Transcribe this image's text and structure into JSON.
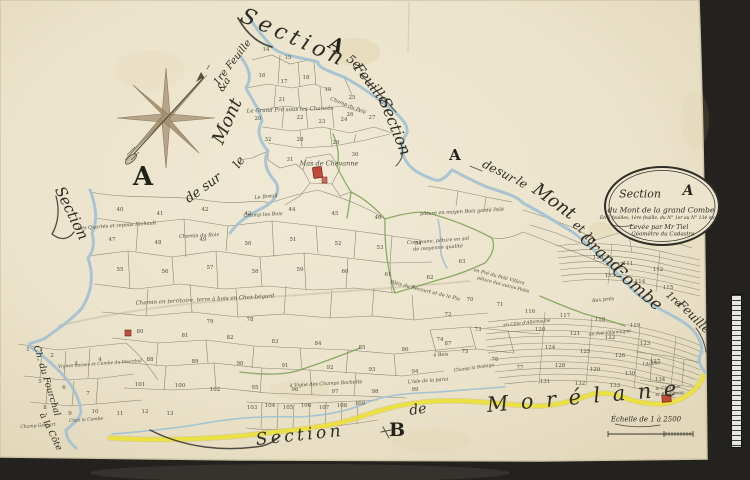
{
  "colors": {
    "background": "#24221f",
    "paper": "#ebe3cb",
    "river": "#a4c2d3",
    "road": "#ece23f",
    "hedge": "#7b9f55",
    "ink": "#2e2d23",
    "building": "#c14a39"
  },
  "cartouche": {
    "word": "Section",
    "letter": "A",
    "line2": "du Mont de la grand Combe",
    "line3": "En 5 feuilles, 1ère feuille, du N° 1er au N° 134 inclus",
    "line4": "Levée par Mr Tiel",
    "line5": "Géomètre du Cadastre"
  },
  "scale_bar": {
    "label": "Échelle de 1 à 2500"
  },
  "map": {
    "script_labels": [
      {
        "t": "Section",
        "x": 293,
        "y": 40,
        "r": 24,
        "s": 22,
        "ls": 2
      },
      {
        "t": "A",
        "x": 335,
        "y": 47,
        "r": 30,
        "s": 19,
        "cls": "cap"
      },
      {
        "t": "5e",
        "x": 353,
        "y": 63,
        "r": 38,
        "s": 12
      },
      {
        "t": "Feuille",
        "x": 370,
        "y": 85,
        "r": 52,
        "s": 14
      },
      {
        "t": "Section",
        "x": 393,
        "y": 127,
        "r": 68,
        "s": 16
      },
      {
        "t": "1re Feuille",
        "x": 233,
        "y": 63,
        "r": -52,
        "s": 10
      },
      {
        "t": "&a",
        "x": 225,
        "y": 85,
        "r": -58,
        "s": 10
      },
      {
        "t": "Mont",
        "x": 229,
        "y": 122,
        "r": -66,
        "s": 18
      },
      {
        "t": "le",
        "x": 240,
        "y": 163,
        "r": -56,
        "s": 12
      },
      {
        "t": "de sur",
        "x": 204,
        "y": 189,
        "r": -36,
        "s": 13
      },
      {
        "t": "Section",
        "x": 70,
        "y": 214,
        "r": 64,
        "s": 15
      },
      {
        "t": "A",
        "x": 143,
        "y": 180,
        "r": 0,
        "s": 26,
        "cls": "cap"
      },
      {
        "t": "A",
        "x": 455,
        "y": 157,
        "r": 0,
        "s": 15,
        "cls": "cap"
      },
      {
        "t": "de",
        "x": 489,
        "y": 168,
        "r": 28,
        "s": 12
      },
      {
        "t": "sur",
        "x": 505,
        "y": 176,
        "r": 30,
        "s": 12
      },
      {
        "t": "le",
        "x": 521,
        "y": 184,
        "r": 33,
        "s": 12
      },
      {
        "t": "Mont",
        "x": 553,
        "y": 203,
        "r": 36,
        "s": 18
      },
      {
        "t": "et",
        "x": 578,
        "y": 228,
        "r": 38,
        "s": 12
      },
      {
        "t": "la",
        "x": 590,
        "y": 240,
        "r": 40,
        "s": 12
      },
      {
        "t": "Grand-",
        "x": 602,
        "y": 256,
        "r": 41,
        "s": 16
      },
      {
        "t": "Combe",
        "x": 636,
        "y": 289,
        "r": 41,
        "s": 17
      },
      {
        "t": "1re",
        "x": 673,
        "y": 300,
        "r": 42,
        "s": 10
      },
      {
        "t": "Feuille",
        "x": 693,
        "y": 318,
        "r": 45,
        "s": 12
      },
      {
        "t": "Section",
        "x": 300,
        "y": 437,
        "r": -6,
        "s": 17,
        "ls": 2
      },
      {
        "t": "B",
        "x": 397,
        "y": 432,
        "r": 0,
        "s": 19,
        "cls": "cap"
      },
      {
        "t": "de",
        "x": 418,
        "y": 411,
        "r": -8,
        "s": 14
      },
      {
        "t": "Morélane",
        "x": 588,
        "y": 399,
        "r": -5,
        "s": 21,
        "ls": 6
      },
      {
        "t": "Ch. du Fourchal",
        "x": 46,
        "y": 381,
        "r": 73,
        "s": 9
      },
      {
        "t": "à la Côte",
        "x": 50,
        "y": 432,
        "r": 64,
        "s": 9
      }
    ],
    "place_labels": [
      {
        "t": "Le Grand Pré sous les Chancés",
        "x": 290,
        "y": 110,
        "r": -2,
        "s": 5.5
      },
      {
        "t": "Champ du Pelé",
        "x": 348,
        "y": 106,
        "r": 22,
        "s": 5
      },
      {
        "t": "Mas de Chevanne",
        "x": 329,
        "y": 164,
        "r": 0,
        "s": 6.5
      },
      {
        "t": "Le Breuil",
        "x": 266,
        "y": 197,
        "r": -5,
        "s": 5
      },
      {
        "t": "Les Quartés et repous Richault",
        "x": 117,
        "y": 226,
        "r": -4,
        "s": 5
      },
      {
        "t": "Chemin du Bois",
        "x": 199,
        "y": 236,
        "r": -3,
        "s": 5
      },
      {
        "t": "Champ les Bois",
        "x": 263,
        "y": 215,
        "r": -3,
        "s": 5
      },
      {
        "t": "pâture en moyen Bois gardé Pelé",
        "x": 462,
        "y": 212,
        "r": -3,
        "s": 5
      },
      {
        "t": "Commune, pâture en sol",
        "x": 438,
        "y": 241,
        "r": -4,
        "s": 5
      },
      {
        "t": "de moyenne qualité",
        "x": 438,
        "y": 248,
        "r": -4,
        "s": 5
      },
      {
        "t": "Chemin en territoire, terre à bois en Chez-bégard",
        "x": 205,
        "y": 300,
        "r": -3,
        "s": 5.5
      },
      {
        "t": "Pâtis du Recourt et de la Pie",
        "x": 425,
        "y": 291,
        "r": 14,
        "s": 5
      },
      {
        "t": "en Pré du Pelé Villars",
        "x": 499,
        "y": 277,
        "r": 15,
        "s": 4.8
      },
      {
        "t": "pâture des autres Pelés",
        "x": 503,
        "y": 285,
        "r": 15,
        "s": 4.5
      },
      {
        "t": "Aux prés",
        "x": 603,
        "y": 300,
        "r": -5,
        "s": 5
      },
      {
        "t": "en Côte d'Allemagne",
        "x": 527,
        "y": 323,
        "r": -6,
        "s": 4.5
      },
      {
        "t": "en Pré Villemagne",
        "x": 610,
        "y": 333,
        "r": -5,
        "s": 4.5
      },
      {
        "t": "à Bois",
        "x": 441,
        "y": 355,
        "r": -3,
        "s": 4.8
      },
      {
        "t": "Champ la Rodage",
        "x": 474,
        "y": 368,
        "r": -8,
        "s": 4.5
      },
      {
        "t": "à Vigne des Champs Rochette",
        "x": 326,
        "y": 384,
        "r": -3,
        "s": 4.8
      },
      {
        "t": "L'isle de la paroi",
        "x": 428,
        "y": 381,
        "r": -4,
        "s": 4.8
      },
      {
        "t": "l'Aubier",
        "x": 652,
        "y": 364,
        "r": -5,
        "s": 4.5
      },
      {
        "t": "le Clos aux",
        "x": 668,
        "y": 388,
        "r": -5,
        "s": 4.5
      },
      {
        "t": "et Bourgeois",
        "x": 670,
        "y": 394,
        "r": -5,
        "s": 4.5
      },
      {
        "t": "Vignes basses et Combe du Fourchal",
        "x": 100,
        "y": 364,
        "r": -4,
        "s": 4.5
      },
      {
        "t": "Champ Gerbert",
        "x": 38,
        "y": 426,
        "r": -4,
        "s": 4.5
      },
      {
        "t": "Chez la Combe",
        "x": 86,
        "y": 420,
        "r": -4,
        "s": 4.5
      },
      {
        "t": "1",
        "x": 208,
        "y": 68,
        "r": 20,
        "s": 6
      }
    ],
    "parcel_numbers": [
      {
        "n": "14",
        "x": 266,
        "y": 50
      },
      {
        "n": "15",
        "x": 288,
        "y": 58
      },
      {
        "n": "16",
        "x": 262,
        "y": 76
      },
      {
        "n": "17",
        "x": 284,
        "y": 82
      },
      {
        "n": "18",
        "x": 306,
        "y": 78
      },
      {
        "n": "19",
        "x": 328,
        "y": 90
      },
      {
        "n": "20",
        "x": 258,
        "y": 119
      },
      {
        "n": "21",
        "x": 282,
        "y": 100
      },
      {
        "n": "22",
        "x": 300,
        "y": 118
      },
      {
        "n": "23",
        "x": 322,
        "y": 122
      },
      {
        "n": "24",
        "x": 344,
        "y": 120
      },
      {
        "n": "25",
        "x": 352,
        "y": 98
      },
      {
        "n": "26",
        "x": 350,
        "y": 115
      },
      {
        "n": "27",
        "x": 372,
        "y": 118
      },
      {
        "n": "28",
        "x": 300,
        "y": 140
      },
      {
        "n": "29",
        "x": 336,
        "y": 143
      },
      {
        "n": "30",
        "x": 355,
        "y": 155
      },
      {
        "n": "31",
        "x": 290,
        "y": 160
      },
      {
        "n": "32",
        "x": 268,
        "y": 140
      },
      {
        "n": "40",
        "x": 120,
        "y": 210
      },
      {
        "n": "41",
        "x": 160,
        "y": 214
      },
      {
        "n": "42",
        "x": 205,
        "y": 210
      },
      {
        "n": "43",
        "x": 248,
        "y": 214
      },
      {
        "n": "44",
        "x": 292,
        "y": 210
      },
      {
        "n": "45",
        "x": 335,
        "y": 214
      },
      {
        "n": "46",
        "x": 378,
        "y": 218
      },
      {
        "n": "47",
        "x": 112,
        "y": 240
      },
      {
        "n": "48",
        "x": 158,
        "y": 243
      },
      {
        "n": "49",
        "x": 203,
        "y": 240
      },
      {
        "n": "50",
        "x": 248,
        "y": 244
      },
      {
        "n": "51",
        "x": 293,
        "y": 240
      },
      {
        "n": "52",
        "x": 338,
        "y": 244
      },
      {
        "n": "53",
        "x": 380,
        "y": 248
      },
      {
        "n": "54",
        "x": 418,
        "y": 244
      },
      {
        "n": "55",
        "x": 120,
        "y": 270
      },
      {
        "n": "56",
        "x": 165,
        "y": 272
      },
      {
        "n": "57",
        "x": 210,
        "y": 268
      },
      {
        "n": "58",
        "x": 255,
        "y": 272
      },
      {
        "n": "59",
        "x": 300,
        "y": 270
      },
      {
        "n": "60",
        "x": 345,
        "y": 272
      },
      {
        "n": "61",
        "x": 388,
        "y": 275
      },
      {
        "n": "62",
        "x": 430,
        "y": 278
      },
      {
        "n": "63",
        "x": 462,
        "y": 262
      },
      {
        "n": "70",
        "x": 470,
        "y": 300
      },
      {
        "n": "71",
        "x": 500,
        "y": 305
      },
      {
        "n": "72",
        "x": 448,
        "y": 315
      },
      {
        "n": "73",
        "x": 478,
        "y": 330
      },
      {
        "n": "74",
        "x": 440,
        "y": 340
      },
      {
        "n": "75",
        "x": 465,
        "y": 352
      },
      {
        "n": "76",
        "x": 495,
        "y": 360
      },
      {
        "n": "77",
        "x": 520,
        "y": 368
      },
      {
        "n": "78",
        "x": 250,
        "y": 320
      },
      {
        "n": "79",
        "x": 210,
        "y": 322
      },
      {
        "n": "80",
        "x": 140,
        "y": 332
      },
      {
        "n": "81",
        "x": 185,
        "y": 336
      },
      {
        "n": "82",
        "x": 230,
        "y": 338
      },
      {
        "n": "83",
        "x": 275,
        "y": 342
      },
      {
        "n": "84",
        "x": 318,
        "y": 344
      },
      {
        "n": "85",
        "x": 362,
        "y": 348
      },
      {
        "n": "86",
        "x": 405,
        "y": 350
      },
      {
        "n": "87",
        "x": 448,
        "y": 344
      },
      {
        "n": "88",
        "x": 150,
        "y": 360
      },
      {
        "n": "89",
        "x": 195,
        "y": 362
      },
      {
        "n": "90",
        "x": 240,
        "y": 364
      },
      {
        "n": "91",
        "x": 285,
        "y": 366
      },
      {
        "n": "92",
        "x": 330,
        "y": 368
      },
      {
        "n": "93",
        "x": 372,
        "y": 370
      },
      {
        "n": "94",
        "x": 415,
        "y": 372
      },
      {
        "n": "95",
        "x": 255,
        "y": 388
      },
      {
        "n": "96",
        "x": 295,
        "y": 390
      },
      {
        "n": "97",
        "x": 335,
        "y": 392
      },
      {
        "n": "98",
        "x": 375,
        "y": 392
      },
      {
        "n": "99",
        "x": 415,
        "y": 390
      },
      {
        "n": "100",
        "x": 180,
        "y": 386
      },
      {
        "n": "101",
        "x": 140,
        "y": 385
      },
      {
        "n": "102",
        "x": 215,
        "y": 390
      },
      {
        "n": "103",
        "x": 252,
        "y": 408
      },
      {
        "n": "104",
        "x": 270,
        "y": 406
      },
      {
        "n": "105",
        "x": 288,
        "y": 408
      },
      {
        "n": "106",
        "x": 306,
        "y": 406
      },
      {
        "n": "107",
        "x": 324,
        "y": 408
      },
      {
        "n": "108",
        "x": 342,
        "y": 406
      },
      {
        "n": "109",
        "x": 360,
        "y": 404
      },
      {
        "n": "1",
        "x": 28,
        "y": 350
      },
      {
        "n": "2",
        "x": 52,
        "y": 356
      },
      {
        "n": "3",
        "x": 76,
        "y": 364
      },
      {
        "n": "4",
        "x": 100,
        "y": 360
      },
      {
        "n": "5",
        "x": 40,
        "y": 382
      },
      {
        "n": "6",
        "x": 64,
        "y": 388
      },
      {
        "n": "7",
        "x": 88,
        "y": 394
      },
      {
        "n": "8",
        "x": 45,
        "y": 408
      },
      {
        "n": "9",
        "x": 70,
        "y": 414
      },
      {
        "n": "10",
        "x": 95,
        "y": 412
      },
      {
        "n": "11",
        "x": 120,
        "y": 414
      },
      {
        "n": "12",
        "x": 145,
        "y": 412
      },
      {
        "n": "13",
        "x": 170,
        "y": 414
      },
      {
        "n": "110",
        "x": 598,
        "y": 258
      },
      {
        "n": "111",
        "x": 628,
        "y": 264
      },
      {
        "n": "112",
        "x": 658,
        "y": 270
      },
      {
        "n": "113",
        "x": 610,
        "y": 276
      },
      {
        "n": "114",
        "x": 640,
        "y": 282
      },
      {
        "n": "115",
        "x": 668,
        "y": 288
      },
      {
        "n": "116",
        "x": 530,
        "y": 312
      },
      {
        "n": "117",
        "x": 565,
        "y": 316
      },
      {
        "n": "118",
        "x": 600,
        "y": 320
      },
      {
        "n": "119",
        "x": 635,
        "y": 326
      },
      {
        "n": "120",
        "x": 540,
        "y": 330
      },
      {
        "n": "121",
        "x": 575,
        "y": 334
      },
      {
        "n": "122",
        "x": 610,
        "y": 338
      },
      {
        "n": "123",
        "x": 645,
        "y": 344
      },
      {
        "n": "124",
        "x": 550,
        "y": 348
      },
      {
        "n": "125",
        "x": 585,
        "y": 352
      },
      {
        "n": "126",
        "x": 620,
        "y": 356
      },
      {
        "n": "127",
        "x": 655,
        "y": 362
      },
      {
        "n": "128",
        "x": 560,
        "y": 366
      },
      {
        "n": "129",
        "x": 595,
        "y": 370
      },
      {
        "n": "130",
        "x": 630,
        "y": 374
      },
      {
        "n": "131",
        "x": 545,
        "y": 382
      },
      {
        "n": "132",
        "x": 580,
        "y": 384
      },
      {
        "n": "133",
        "x": 615,
        "y": 386
      },
      {
        "n": "134",
        "x": 660,
        "y": 380
      }
    ]
  }
}
